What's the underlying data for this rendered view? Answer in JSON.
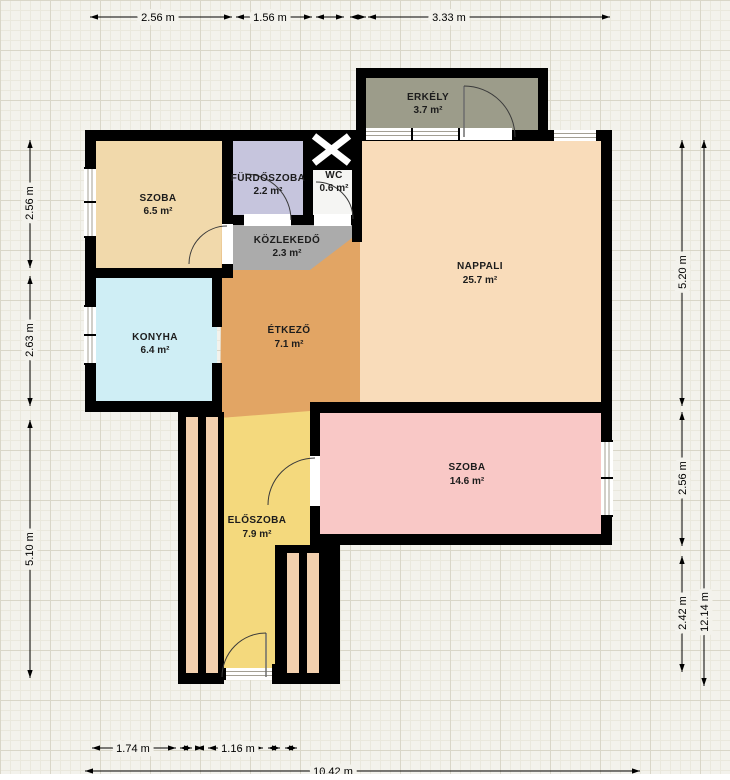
{
  "type": "apartment-floor-plan",
  "rooms": [
    {
      "name": "ERKÉLY",
      "area": "3.7 m²",
      "color": "#9c9c8a"
    },
    {
      "name": "SZOBA",
      "area": "6.5 m²",
      "color": "#f1d9ab"
    },
    {
      "name": "FÜRDŐSZOBA",
      "area": "2.2 m²",
      "color": "#c6c5dd"
    },
    {
      "name": "WC",
      "area": "0.6 m²",
      "color": "#f5f5f3"
    },
    {
      "name": "KÖZLEKEDŐ",
      "area": "2.3 m²",
      "color": "#ababab"
    },
    {
      "name": "NAPPALI",
      "area": "25.7 m²",
      "color": "#f9dcba"
    },
    {
      "name": "KONYHA",
      "area": "6.4 m²",
      "color": "#cfeef5"
    },
    {
      "name": "ÉTKEZŐ",
      "area": "7.1 m²",
      "color": "#e2a564"
    },
    {
      "name": "SZOBA",
      "area": "14.6 m²",
      "color": "#f9c8c6"
    },
    {
      "name": "ELŐSZOBA",
      "area": "7.9 m²",
      "color": "#f4d97d"
    }
  ],
  "dimensions": {
    "top": [
      "2.56 m",
      "1.56 m",
      "3.33 m"
    ],
    "left": [
      "2.56 m",
      "2.63 m",
      "5.10 m"
    ],
    "right": [
      "5.20 m",
      "2.56 m",
      "2.42 m"
    ],
    "right_total": "12.14 m",
    "bottom": [
      "1.74 m",
      "1.16 m"
    ],
    "bottom_total": "10.42 m"
  },
  "wall_color": "#000000",
  "closet_stripe_color": "#f2d0ae"
}
